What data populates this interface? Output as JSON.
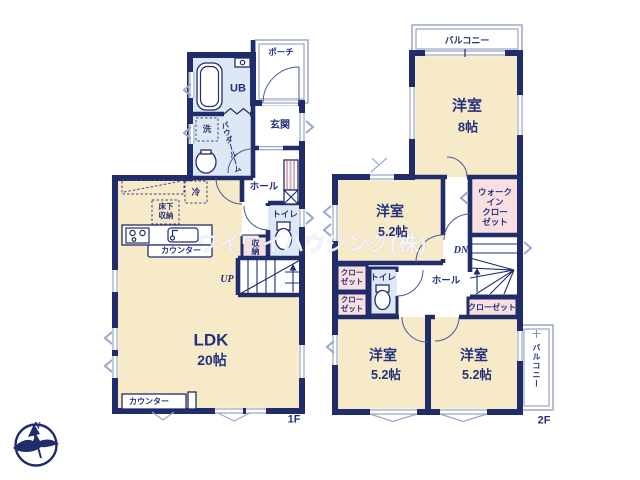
{
  "watermark": "ワイワイハウジング(株)",
  "compass": {
    "north_label": "N"
  },
  "colors": {
    "wall_navy": "#212c6b",
    "room_cream": "#f7eac9",
    "wet_area_blue": "#dee8f4",
    "closet_pink": "#f9dfdf",
    "window_grey": "#9aa6c6"
  },
  "floor1": {
    "label": "1F",
    "porch": "ポーチ",
    "unit_bath": "UB",
    "entrance": "玄関",
    "washer": "洗",
    "powder_room": "パウダールーム",
    "fridge": "冷",
    "underfloor_storage": [
      "床下",
      "収納"
    ],
    "hall": "ホール",
    "toilet": "トイレ",
    "storage": "収納",
    "stairs_up": "UP",
    "kitchen_counter": "カウンター",
    "ldk": "LDK",
    "ldk_size": "20帖",
    "south_counter": "カウンター"
  },
  "floor2": {
    "label": "2F",
    "balcony_north": "バルコニー",
    "room_8": "洋室",
    "room_8_size": "8帖",
    "room_52_north": "洋室",
    "room_52_north_size": "5.2帖",
    "walk_in_closet": [
      "ウォーク",
      "イン",
      "クロー",
      "ゼット"
    ],
    "stairs_down": "DN",
    "hall": "ホール",
    "toilet": "トイレ",
    "closet_west_upper": [
      "クロー",
      "ゼット"
    ],
    "closet_west_lower": [
      "クロー",
      "ゼット"
    ],
    "closet_east": "クローゼット",
    "room_52_sw": "洋室",
    "room_52_sw_size": "5.2帖",
    "room_52_se": "洋室",
    "room_52_se_size": "5.2帖",
    "balcony_east": "バルコニー"
  }
}
